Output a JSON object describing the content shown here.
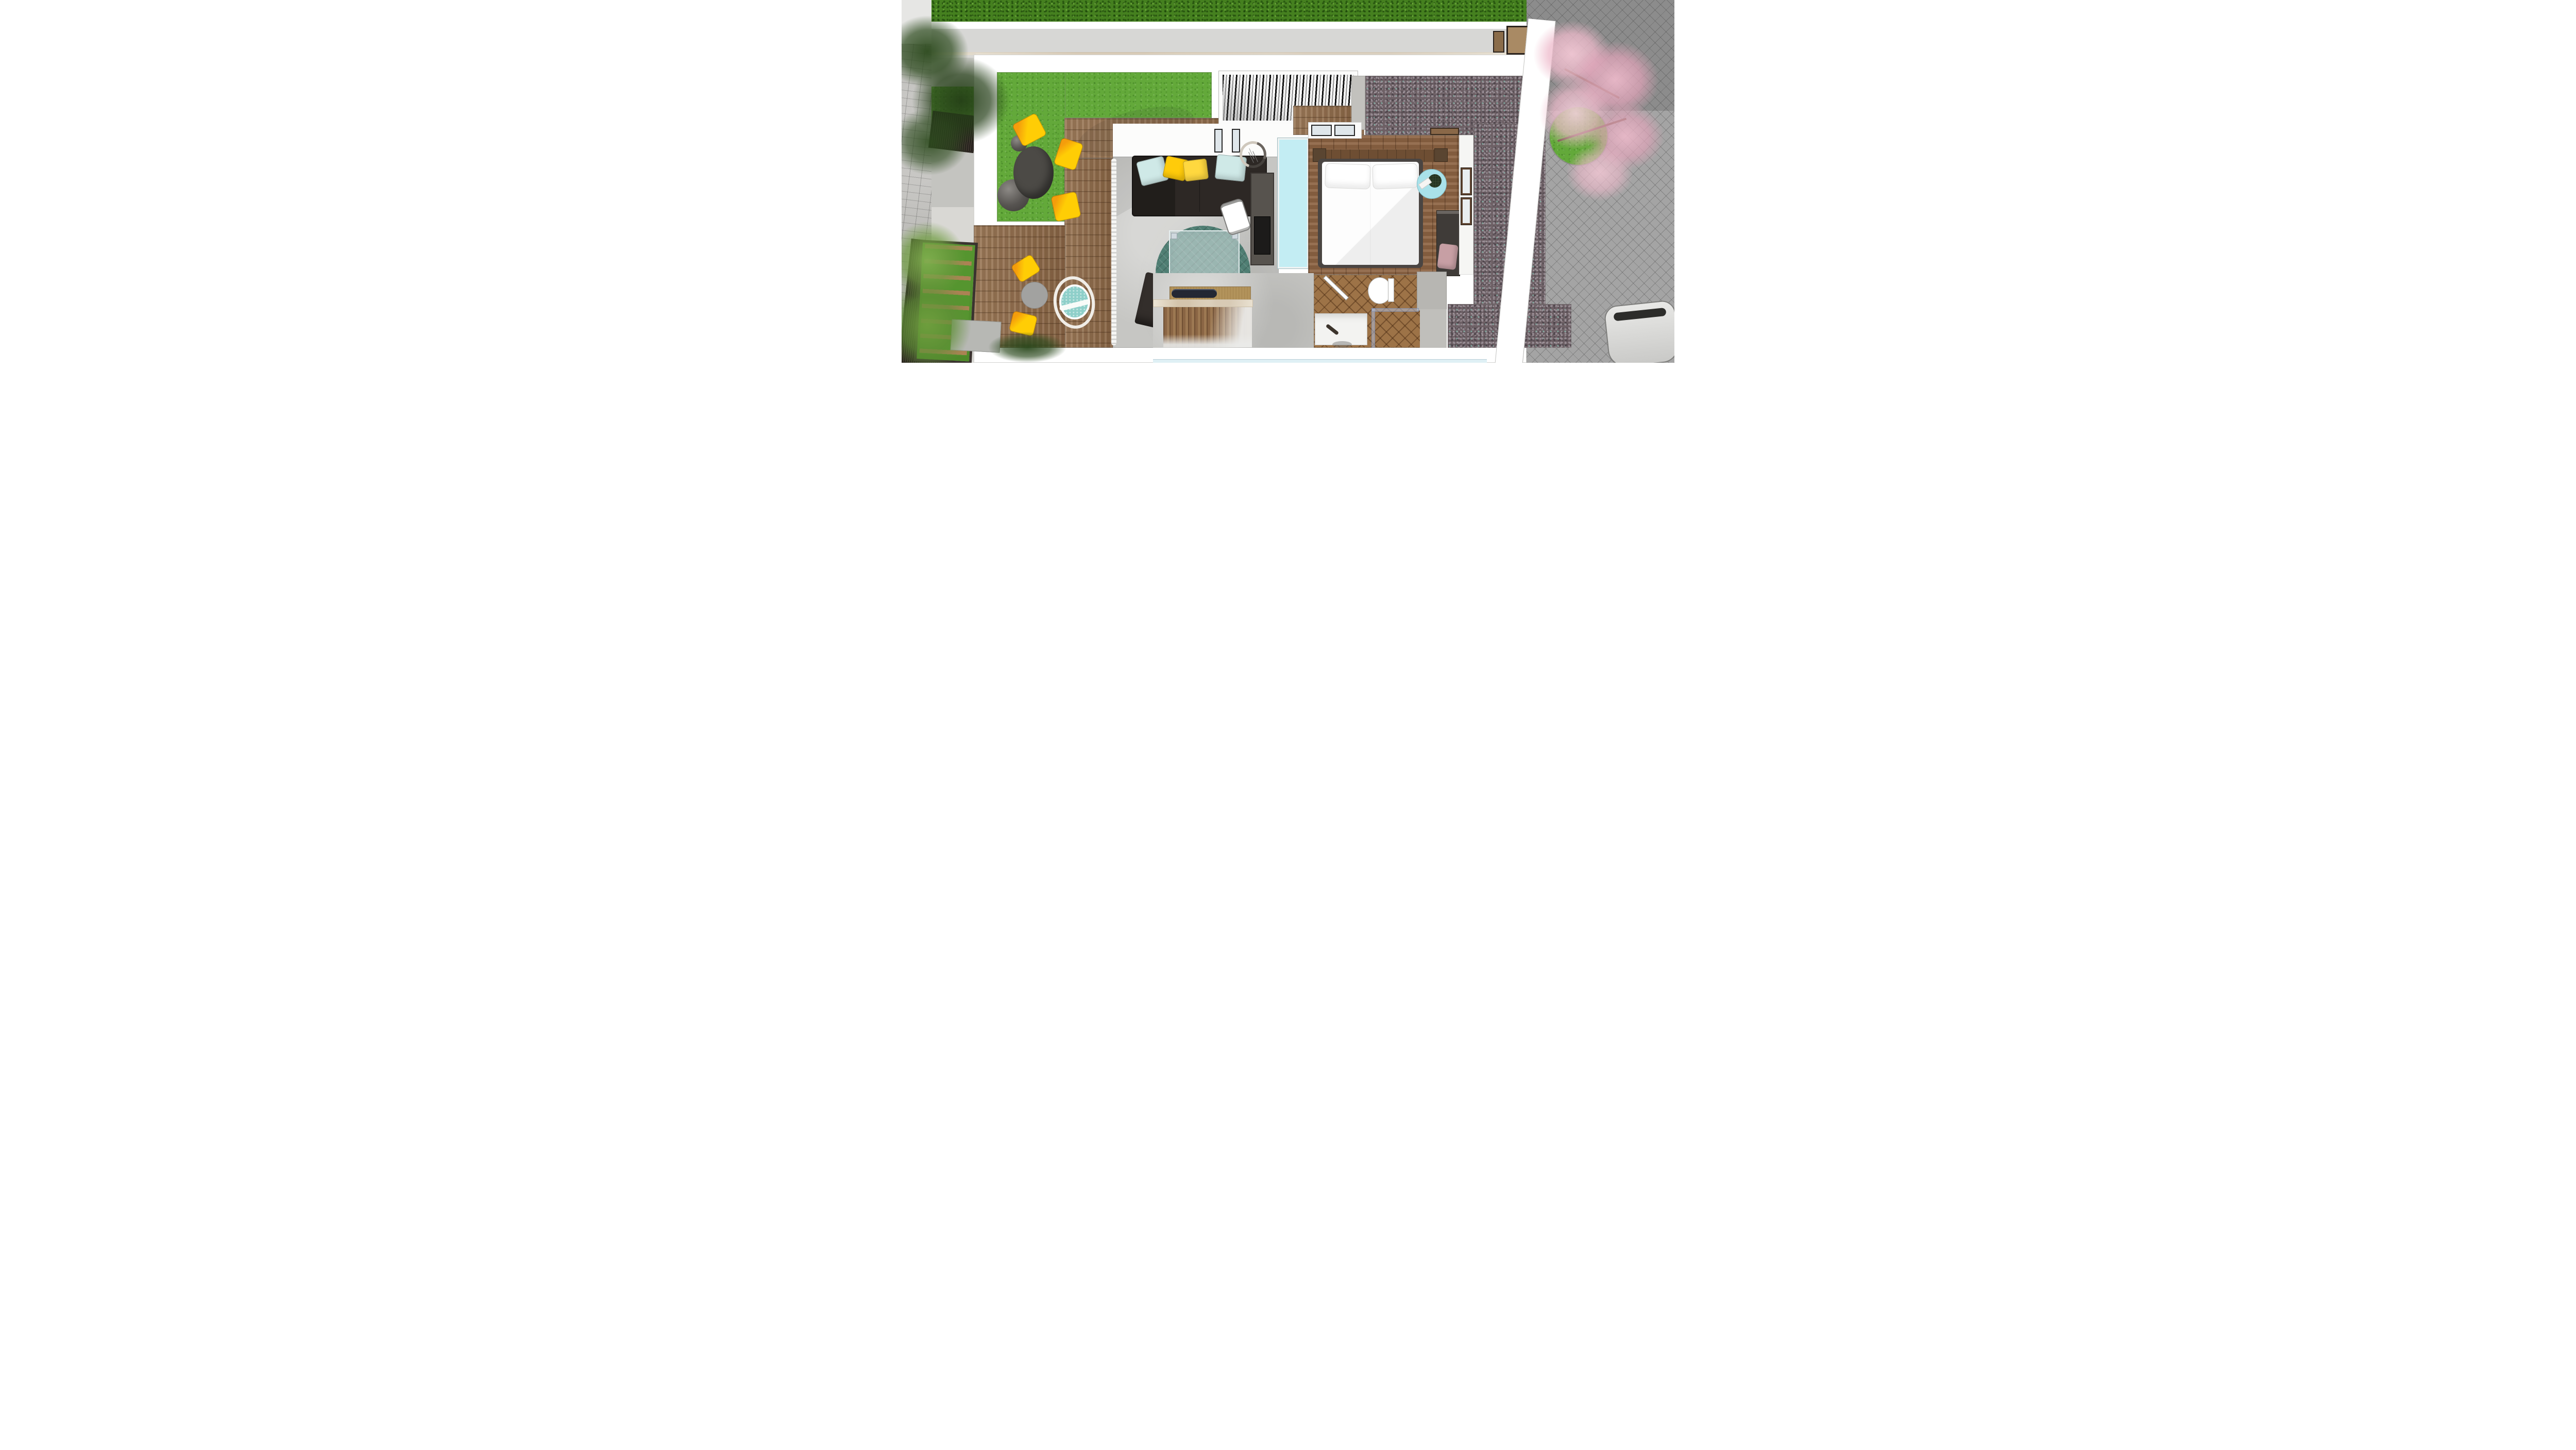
{
  "meta": {
    "title": "Top-down 3D architectural render — rooftop apartment floor plan with terraces",
    "view": "bird's-eye axonometric",
    "visible_text": "none"
  },
  "palette": {
    "hedge": "#45801f",
    "grassRoof": "#63a93a",
    "deckWood": "#8c6847",
    "bedroomWood": "#8a6243",
    "chevronWood": "#9d7347",
    "concrete": "#c6c6c3",
    "gravelBase": "#6d6065",
    "paversRight": "#a4a4a4",
    "paversLeft": "#b5b4b0",
    "wallWhite": "#ffffff",
    "sofa": "#2d2825",
    "ottoman": "#332e2b",
    "pillowBlue": "#cfe9e7",
    "pillowYellow": "#ffcb0a",
    "pillowYellowDeep": "#f0a312",
    "rug": "#4f7e73",
    "rattan": "#f0ede7",
    "eggCushion": "#8ecfc9",
    "chairYellow": "#ffcd05",
    "chairOrange": "#f49d0c",
    "tableDark": "#4c4a46",
    "tableGray": "#a2a2a0",
    "skylight": "#c3edf3",
    "sideTable": "#a9e2ea",
    "bedWhite": "#fdfdfd",
    "bedFrame": "#4a4542",
    "headboard": "#6e4e33",
    "nightstand": "#5a4531",
    "wardrobe": "#3f3b38",
    "cushionPink": "#c79fa4",
    "marble": "#eae2d2",
    "benchWood": "#b99a62",
    "tray": "#232733",
    "blossom": "#f0c2d0",
    "blossomDeep": "#e3a4ba",
    "treeDark": "#2c4a1d",
    "bamboo": "#7fae4e",
    "fence": "#3a322c",
    "lamp": "#cfc8bd",
    "console": "#57534e",
    "bottomGlass": "#dff0f5",
    "carSilver": "#d9d9d9"
  },
  "scene": {
    "exterior": {
      "top_hedge": {
        "material": "dense shrubs",
        "color_ref": "hedge"
      },
      "left_walkway": {
        "material": "stone pavers",
        "items": [
          "dark-slat fence panels",
          "concrete pads",
          "dark leafy tree",
          "bamboo plants",
          "outdoor stair with wood treads over lawn"
        ]
      },
      "right_driveway": {
        "material": "gray herringbone pavers",
        "items": [
          "cherry blossom tree over round lawn bed",
          "white boundary wall",
          "silver car (partial, bottom-right)"
        ]
      }
    },
    "roof_terrace_left": {
      "surface": [
        "green roof lawn (L-shaped)",
        "wood deck"
      ],
      "furniture": [
        "round dark bistro table",
        "3 yellow shell chairs",
        "2 gray decor spheres"
      ]
    },
    "pergola": {
      "type": "louvered slat roof opening",
      "location": "top center"
    },
    "living_room": {
      "floor": "polished concrete",
      "furniture": [
        "dark 3-seat sofa with chaise",
        "2 light-blue pillows",
        "3 yellow pillows",
        "round teal patterned rug",
        "glass coffee table",
        "dark cube ottoman",
        "white desk chair",
        "dark media console with TV",
        "round ring floor lamp",
        "wavy white curtain along west glass wall"
      ]
    },
    "bedroom": {
      "floor": "rustic wood planks",
      "features": [
        "long cyan skylight strip on west side",
        "white closets with glass sliders on north wall",
        "wood headboard ledge with nightstands"
      ],
      "furniture": [
        "double bed, white bedding, 2 pillows, dark frame",
        "round pale-blue side table with flowers and book",
        "dark wardrobe/dresser",
        "pink throw cushion",
        "two wood-framed windows on east wall"
      ]
    },
    "bathroom": {
      "floor": "chevron wood",
      "fixtures": [
        "toilet",
        "white vanity sink with dark faucet",
        "glass shower enclosure",
        "open door leaf"
      ]
    },
    "stairs_kitchen": {
      "items": [
        "wood tread staircase seen from above",
        "white marble counter edge",
        "bamboo wood bench top",
        "dark serving tray"
      ]
    },
    "balcony_bottom_left": {
      "surface": "wood deck",
      "furniture": [
        "hanging egg chair, white rattan with teal cushion",
        "round gray bistro table",
        "2 yellow shell chairs",
        "sheer curtain"
      ]
    },
    "gravel_terrace_right": {
      "material": "dark multicolor gravel, L-shaped"
    },
    "facade_bottom": {
      "feature": "pale blue glass strip along lower edge"
    }
  }
}
